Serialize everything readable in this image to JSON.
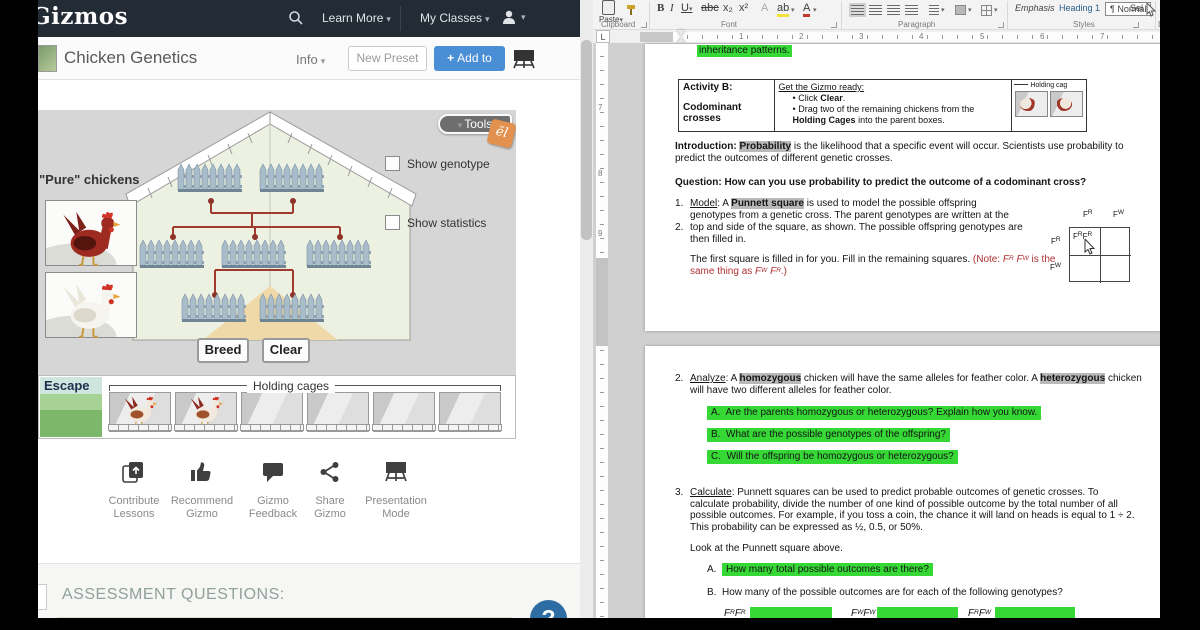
{
  "icons": {
    "caret_down": "▾",
    "plus": "+",
    "help": "?",
    "tools_tri": "▾"
  },
  "colors": {
    "accent_blue": "#4a8ed5",
    "highlight_green": "#35d835",
    "highlight_grey": "#b9b9b9",
    "note_red": "#b03030",
    "navbar": "#232b35"
  },
  "navbar": {
    "logo": "Gizmos",
    "learn_more": "Learn More",
    "my_classes": "My Classes"
  },
  "header": {
    "title": "Chicken Genetics",
    "info": "Info",
    "new_preset": "New Preset",
    "add_to": "Add to"
  },
  "sim": {
    "tools": "Tools",
    "badge": "ĕl",
    "pure_chickens": "\"Pure\" chickens",
    "show_genotype": "Show genotype",
    "show_statistics": "Show statistics",
    "breed": "Breed",
    "clear": "Clear",
    "escape": "Escape",
    "holding_cages": "Holding cages"
  },
  "actions": [
    {
      "l1": "Contribute",
      "l2": "Lessons"
    },
    {
      "l1": "Recommend",
      "l2": "Gizmo"
    },
    {
      "l1": "Gizmo",
      "l2": "Feedback"
    },
    {
      "l1": "Share",
      "l2": "Gizmo"
    },
    {
      "l1": "Presentation",
      "l2": "Mode"
    }
  ],
  "assessment": {
    "title": "ASSESSMENT QUESTIONS:"
  },
  "word": {
    "tab_selector": "L",
    "ribbon": {
      "paste": "Paste",
      "font_b": "B",
      "font_i": "I",
      "font_u": "U",
      "font_abc": "abc",
      "font_sub": "x₂",
      "font_sup": "x²",
      "hl_ab": "ab",
      "fc_a": "A",
      "styles": [
        "Emphasis",
        "Heading 1",
        "¶ Normal"
      ],
      "select": "Sel",
      "groups": {
        "clipboard": "Clipboard",
        "font": "Font",
        "paragraph": "Paragraph",
        "styles": "Styles",
        "edit": "Edit"
      }
    },
    "ruler_h": [
      "1",
      "2",
      "3",
      "4",
      "5",
      "6",
      "7"
    ],
    "ruler_v": [
      "7",
      "8",
      "9"
    ],
    "doc": {
      "top_highlight": "inheritance patterns.",
      "table": {
        "c1a": "Activity B:",
        "c1b": "Codominant crosses",
        "c2_title": "Get the Gizmo ready:",
        "b1_bullet": "•",
        "b1_pre": "Click ",
        "b1_bold": "Clear",
        "b1_post": ".",
        "b2_bullet": "•",
        "b2_pre": "Drag two of the remaining chickens from the ",
        "b2_bold": "Holding Cages",
        "b2_post": " into the parent boxes.",
        "img_label": "Holding cag"
      },
      "intro_label": "Introduction: ",
      "intro_hl": "Probability",
      "intro_rest": " is the likelihood that a specific event will occur. Scientists use probability to predict the outcomes of different genetic crosses.",
      "question": "Question: How can you use probability to predict the outcome of a codominant cross?",
      "i1_num": "1.",
      "i1_u": "Model",
      "i1_pre": ": A ",
      "i1_hl": "Punnett square",
      "i1_rest": " is used to model the possible offspring genotypes from a genetic cross. The parent genotypes are written at the",
      "i2_num": "2.",
      "i2_text": "top and side of the square, as shown. The possible offspring genotypes are then filled in.",
      "fs_black": "The first square is filled in for you. Fill in the remaining squares. ",
      "note_open": "(Note: ",
      "note_mid": " is the same thing as ",
      "note_close": ".)",
      "alleles": {
        "F": "F",
        "R": "R",
        "W": "W"
      },
      "a2_num": "2.",
      "a2_u": "Analyze",
      "a2_pre": ": A ",
      "a2_hl1": "homozygous",
      "a2_mid": " chicken will have the same alleles for feather color. A ",
      "a2_hl2": "heterozygous",
      "a2_rest": " chicken will have two different alleles for feather color.",
      "qa": [
        {
          "n": "A.",
          "t": "Are the parents homozygous or heterozygous? Explain how you know."
        },
        {
          "n": "B.",
          "t": "What are the possible genotypes of the offspring?"
        },
        {
          "n": "C.",
          "t": "Will the offspring be homozygous or heterozygous?"
        }
      ],
      "i3_num": "3.",
      "i3_u": "Calculate",
      "i3_rest": ": Punnett squares can be used to predict probable outcomes of genetic crosses. To calculate probability, divide the number of one kind of possible outcome by the total number of all possible outcomes. For example, if you toss a coin, the chance it will land on heads is equal to 1 ÷ 2. This probability can be expressed as ½, 0.5, or 50%.",
      "look": "Look at the Punnett square above.",
      "c_a_n": "A.",
      "c_a": "How many total possible outcomes are there?",
      "c_b_n": "B.",
      "c_b": "How many of the possible outcomes are for each of the following genotypes?"
    }
  }
}
